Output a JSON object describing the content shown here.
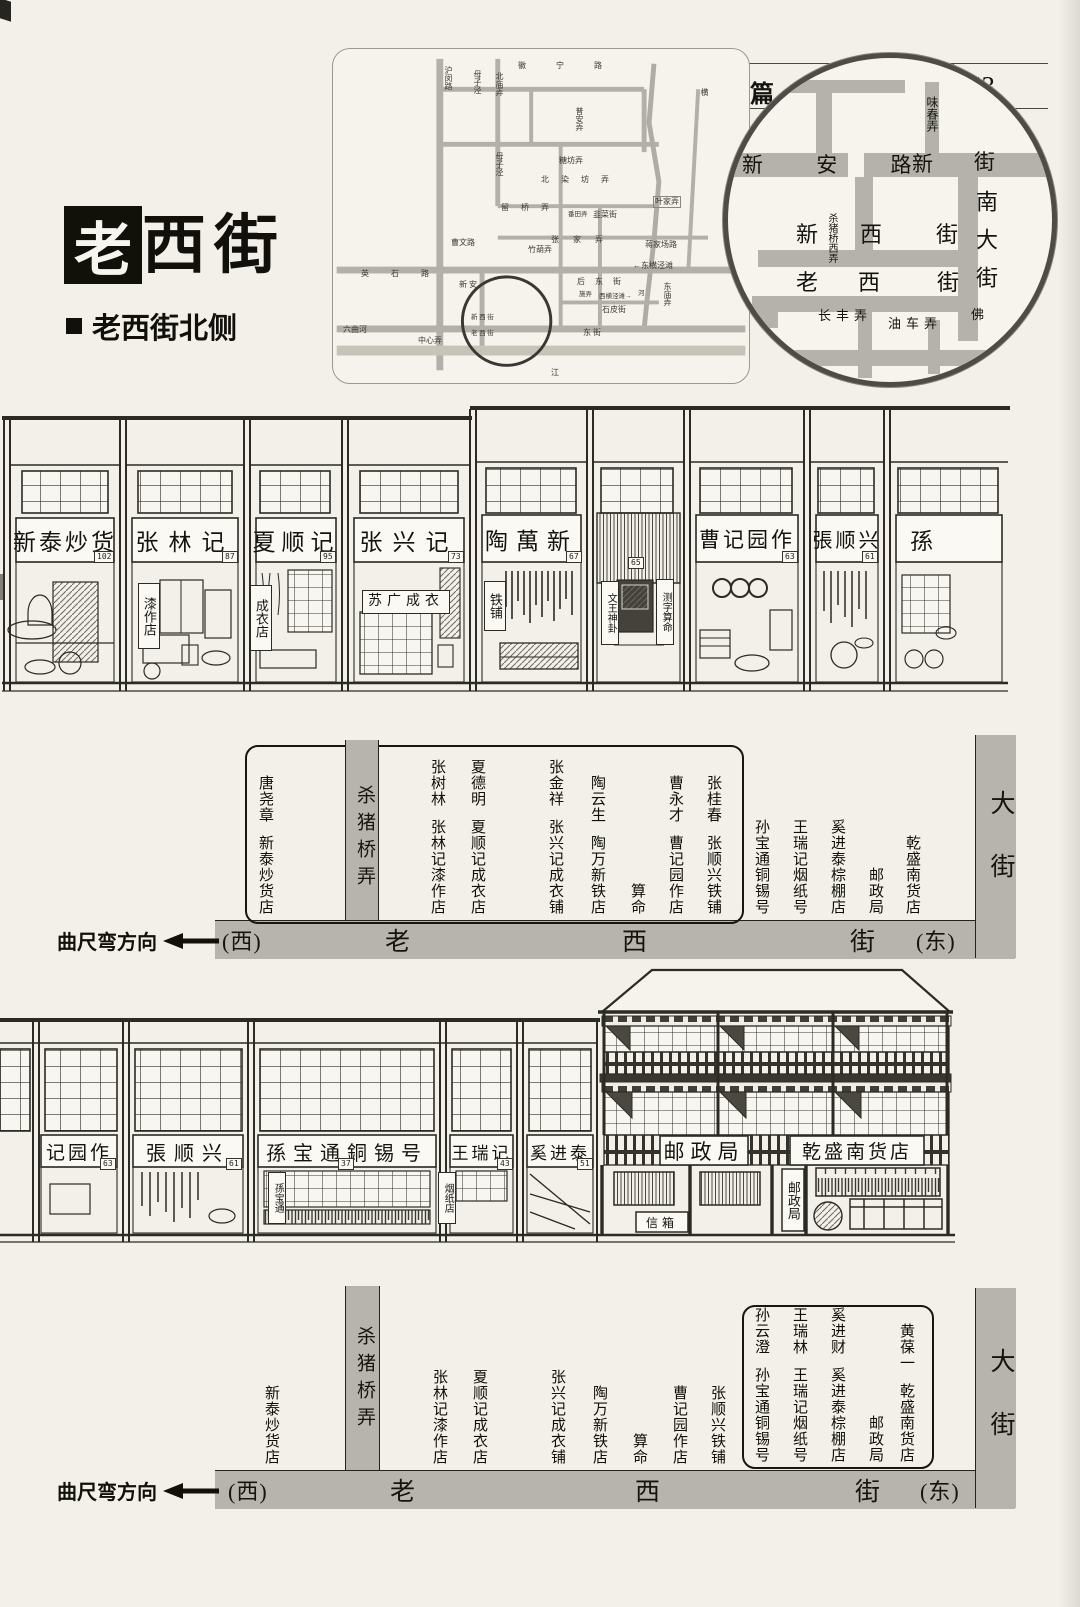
{
  "header": {
    "section": "第二篇",
    "scroll_title": "手绘长卷",
    "page_number": "53"
  },
  "title": {
    "boxed": "老",
    "rest": "西街",
    "subtitle": "老西街北侧"
  },
  "minimap": {
    "labels": [
      "沪闵路",
      "母子泾",
      "北庙弄",
      "徽 宁 路",
      "普安弄",
      "母子泾",
      "糖坊弄",
      "北 染 坊 弄",
      "叶家弄",
      "留 桥 弄",
      "番田弄",
      "韭菜街",
      "张 家 弄",
      "蒋家场路",
      "竹葫弄",
      "曹文路",
      "←东横泾滩",
      "后 东 街",
      "施弄",
      "西横泾滩→",
      "石皮街",
      "东庙弄",
      "英 石 路",
      "新 安",
      "六曲河",
      "中心弄",
      "东 街",
      "新 西 街",
      "老 西 街",
      "江",
      "横",
      "河"
    ]
  },
  "magnifier": {
    "labels": [
      "味春弄",
      "新 安 路",
      "新",
      "街",
      "南大街",
      "新",
      "杀猪桥西弄",
      "西",
      "街",
      "老",
      "西",
      "街",
      "长丰弄",
      "油车弄",
      "佛"
    ]
  },
  "row1": {
    "shops": [
      {
        "sign": "新泰炒货",
        "num": "102"
      },
      {
        "sign": "张林记",
        "num": "87",
        "banner": "漆作店"
      },
      {
        "sign": "夏顺记",
        "num": "95",
        "banner": "成衣店"
      },
      {
        "sign": "张兴记",
        "num": "73",
        "board": "苏广成衣"
      },
      {
        "sign": "陶萬新",
        "num": "67",
        "banner": "铁铺"
      },
      {
        "sign": "",
        "num": "65",
        "banner_left": "文王神卦",
        "banner_right": "测字算命"
      },
      {
        "sign": "曹记园作",
        "num": "63"
      },
      {
        "sign": "張顺兴",
        "num": "61"
      },
      {
        "sign": "孫",
        "num": ""
      }
    ]
  },
  "diagram1": {
    "direction": "曲尺弯方向",
    "west": "(西)",
    "east": "(东)",
    "street": [
      "老",
      "西",
      "街"
    ],
    "lane": "杀猪桥弄",
    "avenue": "大街",
    "columns": [
      {
        "owner": "唐尧章",
        "shop": "新泰炒货店"
      },
      {
        "owner": "张树林",
        "shop": "张林记漆作店"
      },
      {
        "owner": "夏德明",
        "shop": "夏顺记成衣店"
      },
      {
        "owner": "张金祥",
        "shop": "张兴记成衣铺"
      },
      {
        "owner": "陶云生",
        "shop": "陶万新铁店"
      },
      {
        "owner": "",
        "shop": "算命"
      },
      {
        "owner": "曹永才",
        "shop": "曹记园作店"
      },
      {
        "owner": "张桂春",
        "shop": "张顺兴铁铺"
      },
      {
        "owner": "",
        "shop": "孙宝通铜锡号"
      },
      {
        "owner": "",
        "shop": "王瑞记烟纸号"
      },
      {
        "owner": "",
        "shop": "奚进泰棕棚店"
      },
      {
        "owner": "",
        "shop": "邮政局"
      },
      {
        "owner": "",
        "shop": "乾盛南货店"
      }
    ]
  },
  "row2": {
    "shops": [
      {
        "sign": "记园作",
        "num": "63"
      },
      {
        "sign": "張顺兴",
        "num": "61"
      },
      {
        "sign": "孫宝通銅锡号",
        "num": "37",
        "banner": "孫宝通"
      },
      {
        "sign": "王瑞记",
        "num": "43",
        "banner": "烟纸店"
      },
      {
        "sign": "奚进泰",
        "num": "51"
      }
    ],
    "post_office": {
      "sign_left": "邮政局",
      "sign_right": "乾盛南货店",
      "mailbox": "信箱",
      "door_sign": "邮政局"
    }
  },
  "diagram2": {
    "direction": "曲尺弯方向",
    "west": "(西)",
    "east": "(东)",
    "street": [
      "老",
      "西",
      "街"
    ],
    "lane": "杀猪桥弄",
    "avenue": "大街",
    "columns": [
      {
        "owner": "",
        "shop": "新泰炒货店"
      },
      {
        "owner": "",
        "shop": "张林记漆作店"
      },
      {
        "owner": "",
        "shop": "夏顺记成衣店"
      },
      {
        "owner": "",
        "shop": "张兴记成衣铺"
      },
      {
        "owner": "",
        "shop": "陶万新铁店"
      },
      {
        "owner": "",
        "shop": "算命"
      },
      {
        "owner": "",
        "shop": "曹记园作店"
      },
      {
        "owner": "",
        "shop": "张顺兴铁铺"
      }
    ],
    "boxed_columns": [
      {
        "owner": "孙云澄",
        "shop": "孙宝通铜锡号"
      },
      {
        "owner": "王瑞林",
        "shop": "王瑞记烟纸号"
      },
      {
        "owner": "奚进财",
        "shop": "奚进泰棕棚店"
      },
      {
        "owner": "",
        "shop": "邮政局"
      },
      {
        "owner": "黄葆一",
        "shop": "乾盛南货店"
      }
    ]
  },
  "colors": {
    "street_bar": "#b6b4ad",
    "ink": "#1c1b17",
    "paper": "#f2f0e9"
  }
}
